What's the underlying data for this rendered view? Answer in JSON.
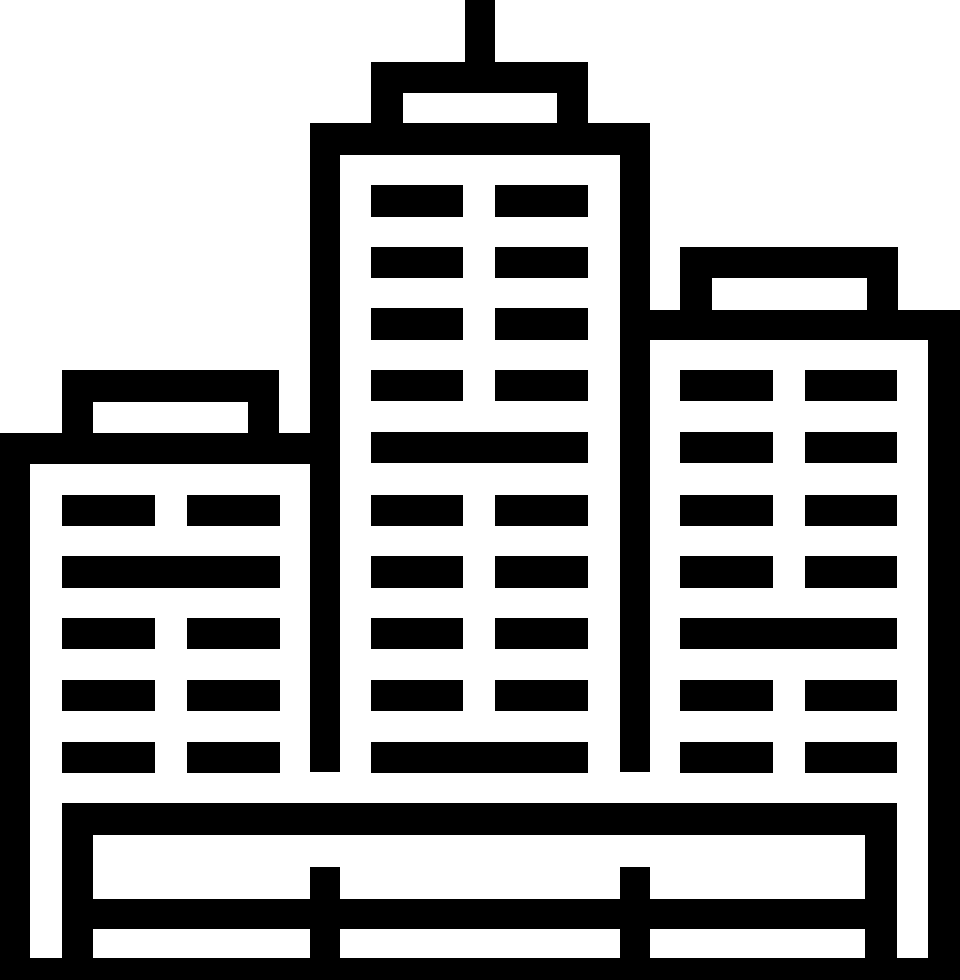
{
  "canvas": {
    "width": 960,
    "height": 980,
    "background_color": "#ffffff",
    "icon_color": "#000000"
  },
  "icon": {
    "name": "city-buildings-icon",
    "description": "Monochrome outline icon of a city skyline: tall center skyscraper with rooftop antenna, left low-rise building, right mid-rise building, window grids, and a fenced ground platform",
    "shapes": [
      {
        "name": "antenna",
        "x": 465,
        "y": 0,
        "w": 30,
        "h": 62
      },
      {
        "name": "center-roof-cap",
        "x": 371,
        "y": 62,
        "w": 217,
        "h": 31
      },
      {
        "name": "center-roof-pillar-left",
        "x": 371,
        "y": 93,
        "w": 32,
        "h": 30
      },
      {
        "name": "center-roof-pillar-right",
        "x": 557,
        "y": 93,
        "w": 31,
        "h": 30
      },
      {
        "name": "center-top-band",
        "x": 310,
        "y": 123,
        "w": 340,
        "h": 32
      },
      {
        "name": "center-wall-left",
        "x": 310,
        "y": 155,
        "w": 30,
        "h": 617
      },
      {
        "name": "center-wall-right",
        "x": 620,
        "y": 155,
        "w": 30,
        "h": 617
      },
      {
        "name": "left-roof-cap",
        "x": 62,
        "y": 370,
        "w": 217,
        "h": 32
      },
      {
        "name": "left-roof-pillar-left",
        "x": 62,
        "y": 402,
        "w": 31,
        "h": 31
      },
      {
        "name": "left-roof-pillar-right",
        "x": 248,
        "y": 402,
        "w": 31,
        "h": 31
      },
      {
        "name": "left-top-band",
        "x": 0,
        "y": 433,
        "w": 340,
        "h": 31
      },
      {
        "name": "frame-wall-left",
        "x": 0,
        "y": 433,
        "w": 30,
        "h": 547
      },
      {
        "name": "right-roof-cap",
        "x": 680,
        "y": 247,
        "w": 218,
        "h": 31
      },
      {
        "name": "right-roof-pillar-left",
        "x": 680,
        "y": 278,
        "w": 32,
        "h": 32
      },
      {
        "name": "right-roof-pillar-right",
        "x": 867,
        "y": 278,
        "w": 31,
        "h": 32
      },
      {
        "name": "right-top-band",
        "x": 650,
        "y": 310,
        "w": 310,
        "h": 30
      },
      {
        "name": "right-wall-right",
        "x": 928,
        "y": 340,
        "w": 32,
        "h": 640
      },
      {
        "name": "left-window-r1a",
        "x": 62,
        "y": 495,
        "w": 93,
        "h": 31
      },
      {
        "name": "left-window-r1b",
        "x": 187,
        "y": 495,
        "w": 93,
        "h": 31
      },
      {
        "name": "left-window-wide",
        "x": 62,
        "y": 556,
        "w": 218,
        "h": 32
      },
      {
        "name": "left-window-r3a",
        "x": 62,
        "y": 618,
        "w": 93,
        "h": 31
      },
      {
        "name": "left-window-r3b",
        "x": 187,
        "y": 618,
        "w": 93,
        "h": 31
      },
      {
        "name": "left-window-r4a",
        "x": 62,
        "y": 680,
        "w": 93,
        "h": 31
      },
      {
        "name": "left-window-r4b",
        "x": 187,
        "y": 680,
        "w": 93,
        "h": 31
      },
      {
        "name": "left-window-r5a",
        "x": 62,
        "y": 742,
        "w": 93,
        "h": 31
      },
      {
        "name": "left-window-r5b",
        "x": 187,
        "y": 742,
        "w": 93,
        "h": 31
      },
      {
        "name": "center-window-r1a",
        "x": 371,
        "y": 185,
        "w": 92,
        "h": 32
      },
      {
        "name": "center-window-r1b",
        "x": 495,
        "y": 185,
        "w": 93,
        "h": 32
      },
      {
        "name": "center-window-r2a",
        "x": 371,
        "y": 247,
        "w": 92,
        "h": 31
      },
      {
        "name": "center-window-r2b",
        "x": 495,
        "y": 247,
        "w": 93,
        "h": 31
      },
      {
        "name": "center-window-r3a",
        "x": 371,
        "y": 308,
        "w": 92,
        "h": 32
      },
      {
        "name": "center-window-r3b",
        "x": 495,
        "y": 308,
        "w": 93,
        "h": 32
      },
      {
        "name": "center-window-r4a",
        "x": 371,
        "y": 370,
        "w": 92,
        "h": 31
      },
      {
        "name": "center-window-r4b",
        "x": 495,
        "y": 370,
        "w": 93,
        "h": 31
      },
      {
        "name": "center-window-wide-upper",
        "x": 371,
        "y": 432,
        "w": 217,
        "h": 31
      },
      {
        "name": "center-window-r6a",
        "x": 371,
        "y": 495,
        "w": 92,
        "h": 31
      },
      {
        "name": "center-window-r6b",
        "x": 495,
        "y": 495,
        "w": 93,
        "h": 31
      },
      {
        "name": "center-window-r7a",
        "x": 371,
        "y": 556,
        "w": 92,
        "h": 32
      },
      {
        "name": "center-window-r7b",
        "x": 495,
        "y": 556,
        "w": 93,
        "h": 32
      },
      {
        "name": "center-window-r8a",
        "x": 371,
        "y": 618,
        "w": 92,
        "h": 31
      },
      {
        "name": "center-window-r8b",
        "x": 495,
        "y": 618,
        "w": 93,
        "h": 31
      },
      {
        "name": "center-window-r9a",
        "x": 371,
        "y": 680,
        "w": 92,
        "h": 31
      },
      {
        "name": "center-window-r9b",
        "x": 495,
        "y": 680,
        "w": 93,
        "h": 31
      },
      {
        "name": "center-window-wide-lower",
        "x": 371,
        "y": 742,
        "w": 217,
        "h": 31
      },
      {
        "name": "right-window-r1a",
        "x": 680,
        "y": 370,
        "w": 93,
        "h": 31
      },
      {
        "name": "right-window-r1b",
        "x": 805,
        "y": 370,
        "w": 92,
        "h": 31
      },
      {
        "name": "right-window-r2a",
        "x": 680,
        "y": 432,
        "w": 93,
        "h": 31
      },
      {
        "name": "right-window-r2b",
        "x": 805,
        "y": 432,
        "w": 92,
        "h": 31
      },
      {
        "name": "right-window-r3a",
        "x": 680,
        "y": 495,
        "w": 93,
        "h": 31
      },
      {
        "name": "right-window-r3b",
        "x": 805,
        "y": 495,
        "w": 92,
        "h": 31
      },
      {
        "name": "right-window-r4a",
        "x": 680,
        "y": 556,
        "w": 93,
        "h": 32
      },
      {
        "name": "right-window-r4b",
        "x": 805,
        "y": 556,
        "w": 92,
        "h": 32
      },
      {
        "name": "right-window-wide",
        "x": 680,
        "y": 618,
        "w": 217,
        "h": 31
      },
      {
        "name": "right-window-r6a",
        "x": 680,
        "y": 680,
        "w": 93,
        "h": 31
      },
      {
        "name": "right-window-r6b",
        "x": 805,
        "y": 680,
        "w": 92,
        "h": 31
      },
      {
        "name": "right-window-r7a",
        "x": 680,
        "y": 742,
        "w": 93,
        "h": 31
      },
      {
        "name": "right-window-r7b",
        "x": 805,
        "y": 742,
        "w": 92,
        "h": 31
      },
      {
        "name": "base-deck-band",
        "x": 62,
        "y": 803,
        "w": 835,
        "h": 32
      },
      {
        "name": "base-wall-left",
        "x": 62,
        "y": 835,
        "w": 31,
        "h": 123
      },
      {
        "name": "base-wall-inner-right",
        "x": 865,
        "y": 835,
        "w": 32,
        "h": 123
      },
      {
        "name": "base-rail",
        "x": 62,
        "y": 899,
        "w": 835,
        "h": 30
      },
      {
        "name": "base-post-left",
        "x": 310,
        "y": 867,
        "w": 30,
        "h": 91
      },
      {
        "name": "base-post-right",
        "x": 620,
        "y": 867,
        "w": 30,
        "h": 91
      },
      {
        "name": "ground-band",
        "x": 0,
        "y": 958,
        "w": 960,
        "h": 22
      }
    ]
  }
}
